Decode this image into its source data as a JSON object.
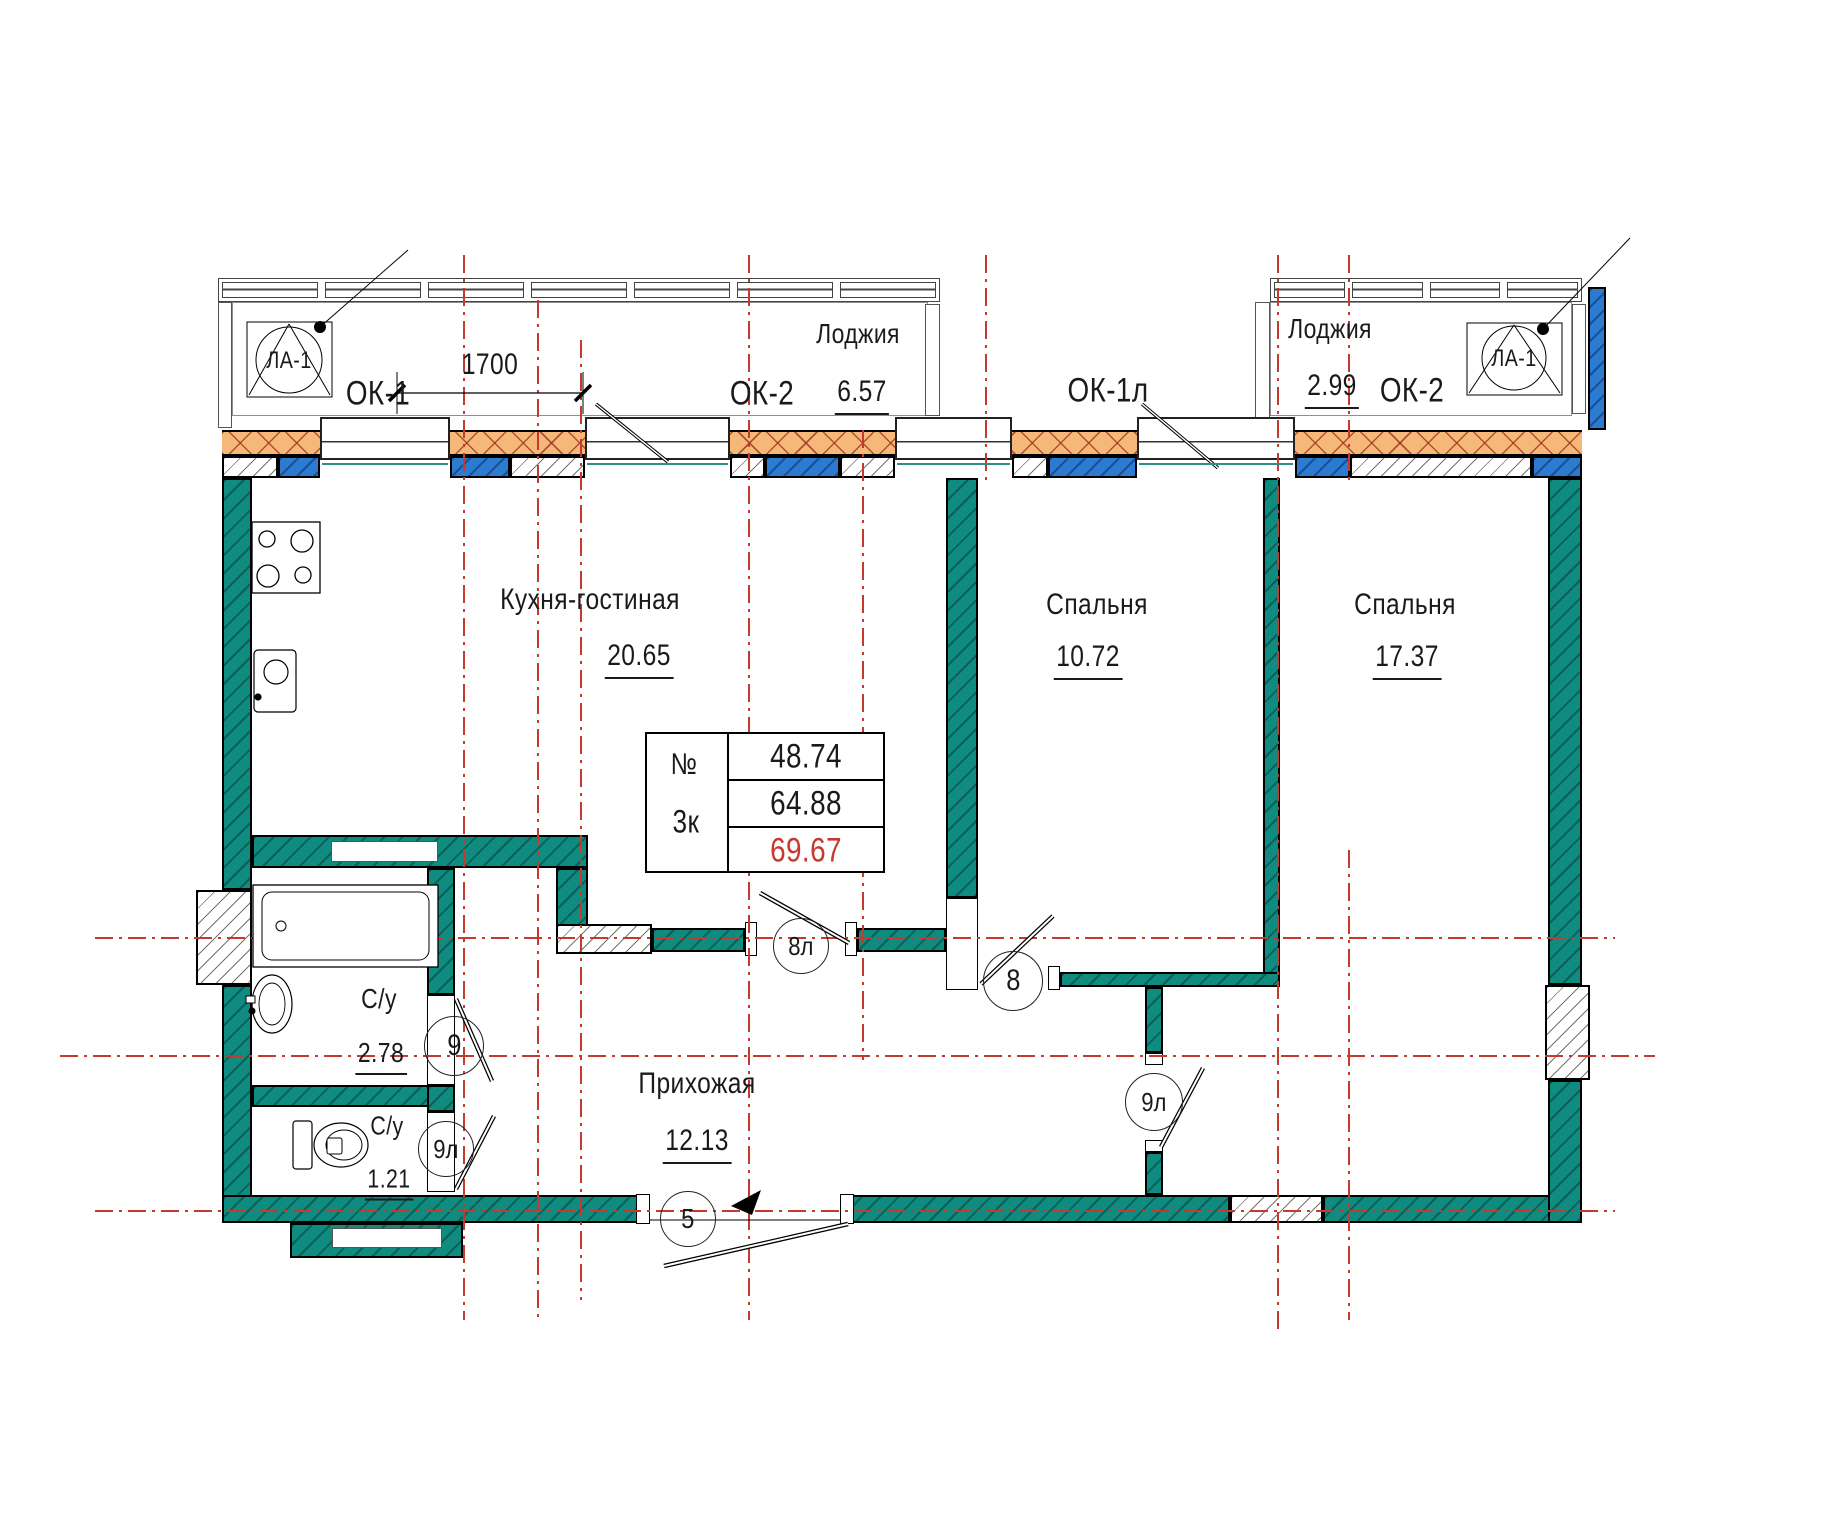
{
  "plan": {
    "rooms": [
      {
        "name": "Кухня-гостиная",
        "area": "20.65"
      },
      {
        "name": "Спальня",
        "area": "10.72"
      },
      {
        "name": "Спальня",
        "area": "17.37"
      },
      {
        "name": "Прихожая",
        "area": "12.13"
      },
      {
        "name": "С/у",
        "area": "2.78"
      },
      {
        "name": "С/у",
        "area": "1.21"
      },
      {
        "name": "Лоджия",
        "area": "6.57"
      },
      {
        "name": "Лоджия",
        "area": "2.99"
      }
    ],
    "windows": {
      "ok1": "ОК-1",
      "ok2_left": "ОК-2",
      "ok1l": "ОК-1л",
      "ok2_right": "ОК-2"
    },
    "markers": {
      "la1_left": "ЛА-1",
      "la1_right": "ЛА-1"
    },
    "dimension": "1700",
    "doors": {
      "entrance": "5",
      "living": "8л",
      "bedroom1": "8",
      "bath1": "9",
      "bath2": "9л",
      "bedroom2": "9л"
    },
    "info_table": {
      "number_label": "№",
      "apartment_type": "3к",
      "living_area": "48.74",
      "floor_area": "64.88",
      "total_area": "69.67"
    },
    "colors": {
      "wall_teal": "#0F8B80",
      "pier_blue": "#2B7CD0",
      "insulation_orange": "#F6B878",
      "axis_red": "#C6392F",
      "total_area_red": "#C6392F"
    }
  }
}
